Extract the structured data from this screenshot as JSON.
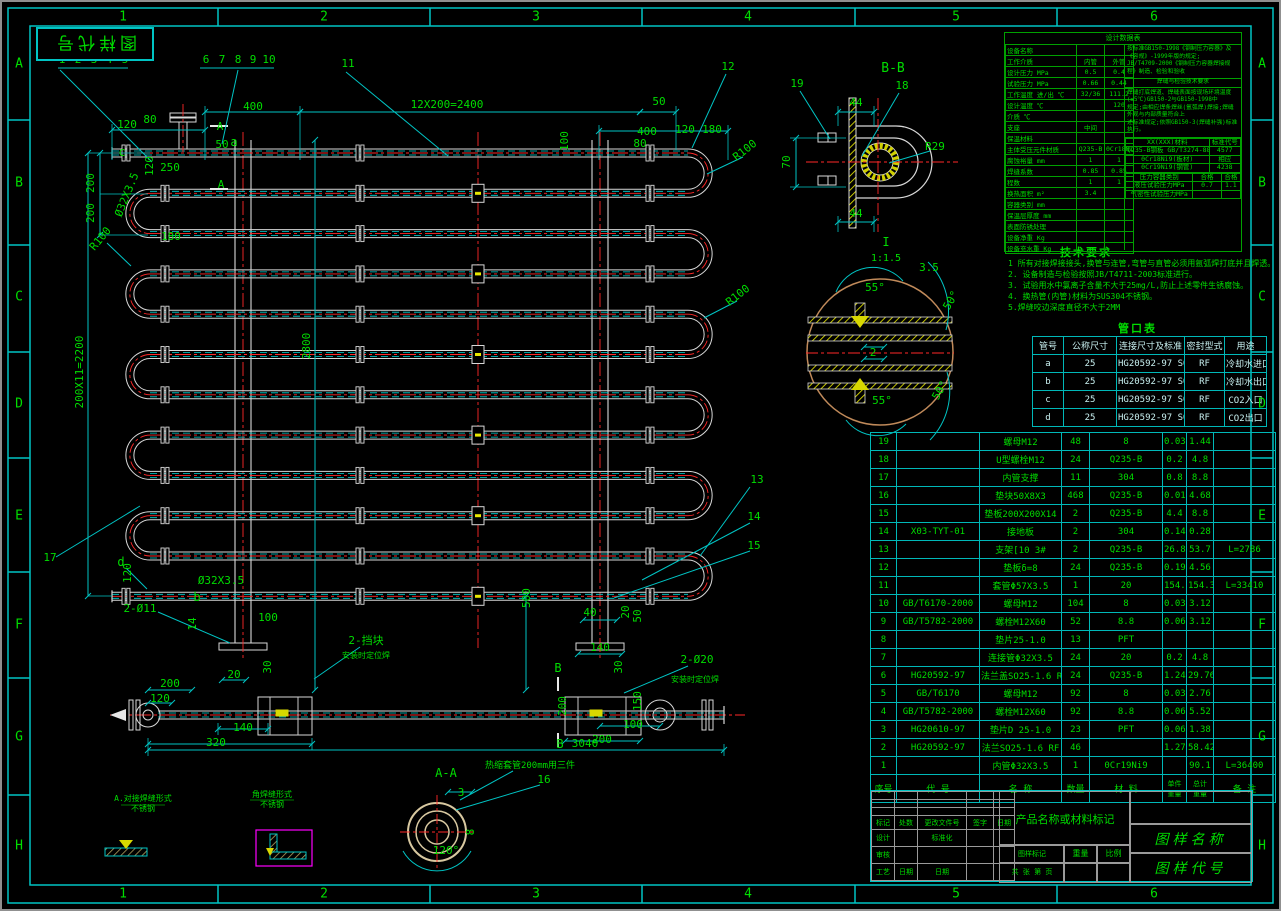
{
  "stamp": "图样代号",
  "frame": {
    "cols": [
      "1",
      "2",
      "3",
      "4",
      "5",
      "6"
    ],
    "rows": [
      "A",
      "B",
      "C",
      "D",
      "E",
      "F",
      "G",
      "H"
    ]
  },
  "tech_notes": {
    "title": "技术要求",
    "lines": [
      "1  所有对接焊接接头,换管与连管,弯管与直管必须用氩弧焊打底并且焊透。",
      "2. 设备制造与检验按照JB/T4711-2003标准进行。",
      "3. 试验用水中氯离子含量不大于25mg/L,防止上述零件生锈腐蚀。",
      "4. 换热管(内管)材料为SUS304不锈钢。",
      "5.焊缝咬边深度直径不大于2MM"
    ]
  },
  "nozzle_table": {
    "title": "管口表",
    "headers": [
      "管号",
      "公称尺寸",
      "连接尺寸及标准",
      "密封型式",
      "用途"
    ],
    "rows": [
      [
        "a",
        "25",
        "HG20592-97 SO25-1.6",
        "RF",
        "冷却水进口"
      ],
      [
        "b",
        "25",
        "HG20592-97 SO25-1.6",
        "RF",
        "冷却水出口"
      ],
      [
        "c",
        "25",
        "HG20592-97 SO25-1.6",
        "RF",
        "CO2入口"
      ],
      [
        "d",
        "25",
        "HG20592-97 SO25-1.6",
        "RF",
        "CO2出口"
      ]
    ]
  },
  "params_table": {
    "title": "设计数据表",
    "rows": [
      [
        "设备名称",
        "",
        ""
      ],
      [
        "工作介质",
        "内管",
        "外管"
      ],
      [
        "设计压力 MPa",
        "0.5",
        "0.4"
      ],
      [
        "试验压力 MPa",
        "0.66",
        "0.44"
      ],
      [
        "工作温度 进/出 ℃",
        "32/36",
        "111.2"
      ],
      [
        "设计温度 ℃",
        "",
        "120"
      ],
      [
        "介质 ℃",
        "",
        ""
      ],
      [
        "支座",
        "中间",
        ""
      ],
      [
        "保温材料",
        "",
        ""
      ],
      [
        "主体受压元件材质",
        "Q235-B",
        "0Cr18Ni9"
      ],
      [
        "腐蚀裕量 mm",
        "1",
        "1"
      ],
      [
        "焊缝系数",
        "0.85",
        "0.85"
      ],
      [
        "程数",
        "1",
        "1"
      ],
      [
        "换热面积 m²",
        "3.4",
        ""
      ],
      [
        "容器类别 mm",
        "",
        ""
      ],
      [
        "保温层厚度 mm",
        "",
        ""
      ],
      [
        "表面防锈处理",
        "",
        ""
      ],
      [
        "设备净重 Kg",
        "",
        ""
      ],
      [
        "设备充水重 Kg",
        "",
        ""
      ]
    ],
    "right": {
      "reg_lines": [
        "按标准GB150-1998《钢制压力容器》及《容规》-1999年版的规定;",
        "JB/T4709-2000《钢制压力容器焊接规程》制造、检验和验收"
      ],
      "weld_title": "焊缝与检验技术要求",
      "weld_lines": [
        "焊缝打底焊道、焊缝表面按现场环境温度(≥5℃)GB150-2与GB150-1998中",
        "规定;由相应焊条焊丝(氩弧焊)焊接;焊缝外观与内部质量符合上",
        "述标准规定;依照GB150-3(焊缝补强)标准执行。"
      ],
      "std_headers": [
        "XX(XXX)材料",
        "标准代号"
      ],
      "std_rows": [
        [
          "Q235-B钢板 GB/T3274-88",
          "4577"
        ],
        [
          "0Cr18Ni9(板材)",
          "相应"
        ],
        [
          "0Cr19Ni9(钢管)",
          "4238"
        ]
      ],
      "test_rows": [
        [
          "压力容器类别",
          "合格",
          "合格"
        ],
        [
          "液压试验压力MPa",
          "0.7",
          "1.1"
        ],
        [
          "气密性试验压力MPa",
          "",
          ""
        ]
      ]
    }
  },
  "bom": {
    "footer": [
      "序号",
      "代  号",
      "名  称",
      "数量",
      "材  料",
      "单件",
      "总计",
      "备  注"
    ],
    "weight_label": "重量",
    "rows": [
      [
        "19",
        "",
        "螺母M12",
        "48",
        "8",
        "0.03",
        "1.44",
        ""
      ],
      [
        "18",
        "",
        "U型螺栓M12",
        "24",
        "Q235-B",
        "0.2",
        "4.8",
        ""
      ],
      [
        "17",
        "",
        "内管支撑",
        "11",
        "304",
        "0.8",
        "8.8",
        ""
      ],
      [
        "16",
        "",
        "垫块50X8X3",
        "468",
        "Q235-B",
        "0.01",
        "4.68",
        ""
      ],
      [
        "15",
        "",
        "垫板200X200X14",
        "2",
        "Q235-B",
        "4.4",
        "8.8",
        ""
      ],
      [
        "14",
        "X03-TYT-01",
        "接地板",
        "2",
        "304",
        "0.14",
        "0.28",
        ""
      ],
      [
        "13",
        "",
        "支架[10 3#",
        "2",
        "Q235-B",
        "26.85",
        "53.7",
        "L=2786"
      ],
      [
        "12",
        "",
        "垫板δ=8",
        "24",
        "Q235-B",
        "0.19",
        "4.56",
        ""
      ],
      [
        "11",
        "",
        "套管Φ57X3.5",
        "1",
        "20",
        "154.3",
        "154.3",
        "L=33410"
      ],
      [
        "10",
        "GB/T6170-2000",
        "螺母M12",
        "104",
        "8",
        "0.03",
        "3.12",
        ""
      ],
      [
        "9",
        "GB/T5782-2000",
        "螺栓M12X60",
        "52",
        "8.8",
        "0.06",
        "3.12",
        ""
      ],
      [
        "8",
        "",
        "垫片25-1.0",
        "13",
        "PFT",
        "",
        "",
        ""
      ],
      [
        "7",
        "",
        "连接管Φ32X3.5",
        "24",
        "20",
        "0.2",
        "4.8",
        ""
      ],
      [
        "6",
        "HG20592-97",
        "法兰盖SO25-1.6 RF",
        "24",
        "Q235-B",
        "1.24",
        "29.76",
        ""
      ],
      [
        "5",
        "GB/T6170",
        "螺母M12",
        "92",
        "8",
        "0.03",
        "2.76",
        ""
      ],
      [
        "4",
        "GB/T5782-2000",
        "螺栓M12X60",
        "92",
        "8.8",
        "0.06",
        "5.52",
        ""
      ],
      [
        "3",
        "HG20610-97",
        "垫片D 25-1.0",
        "23",
        "PFT",
        "0.06",
        "1.38",
        ""
      ],
      [
        "2",
        "HG20592-97",
        "法兰SO25-1.6 RF",
        "46",
        "",
        "1.27",
        "58.42",
        ""
      ],
      [
        "1",
        "",
        "内管Φ32X3.5",
        "1",
        "0Cr19Ni9",
        "",
        "90.1",
        "L=36400"
      ]
    ]
  },
  "title_block": {
    "product_mark": "产品名称或材料标记",
    "name_label": "图样名称",
    "code_label": "图样代号",
    "left_header": [
      "标记",
      "处数",
      "更改文件号",
      "签字",
      "日期"
    ],
    "roles": [
      [
        "设计",
        "",
        "标准化",
        ""
      ],
      [
        "审核",
        "",
        "",
        ""
      ],
      [
        "工艺",
        "日期",
        "日期",
        ""
      ]
    ],
    "mark_label": "图样标记",
    "weight": "重量",
    "scale": "比例",
    "sheet": "共 张 第 页"
  },
  "annotations": [
    {
      "t": "1",
      "x": 62,
      "y": 63
    },
    {
      "t": "2",
      "x": 78,
      "y": 63
    },
    {
      "t": "3",
      "x": 94,
      "y": 63
    },
    {
      "t": "4",
      "x": 109,
      "y": 63
    },
    {
      "t": "5",
      "x": 125,
      "y": 63
    },
    {
      "t": "6",
      "x": 206,
      "y": 63
    },
    {
      "t": "7",
      "x": 222,
      "y": 63
    },
    {
      "t": "8",
      "x": 238,
      "y": 63
    },
    {
      "t": "9",
      "x": 253,
      "y": 63
    },
    {
      "t": "10",
      "x": 269,
      "y": 63
    },
    {
      "t": "11",
      "x": 348,
      "y": 67
    },
    {
      "t": "12",
      "x": 728,
      "y": 70
    },
    {
      "t": "a",
      "x": 234,
      "y": 146,
      "s": 12
    },
    {
      "t": "400",
      "x": 253,
      "y": 110
    },
    {
      "t": "12X200=2400",
      "x": 447,
      "y": 108
    },
    {
      "t": "50",
      "x": 659,
      "y": 105
    },
    {
      "t": "120",
      "x": 127,
      "y": 128
    },
    {
      "t": "80",
      "x": 150,
      "y": 123
    },
    {
      "t": "A",
      "x": 220,
      "y": 130
    },
    {
      "t": "50",
      "x": 222,
      "y": 148
    },
    {
      "t": "120",
      "x": 153,
      "y": 166,
      "r": -90
    },
    {
      "t": "c",
      "x": 122,
      "y": 156,
      "s": 12
    },
    {
      "t": "250",
      "x": 170,
      "y": 171
    },
    {
      "t": "A",
      "x": 221,
      "y": 188
    },
    {
      "t": "100",
      "x": 568,
      "y": 141,
      "r": -90
    },
    {
      "t": "400",
      "x": 647,
      "y": 135
    },
    {
      "t": "80",
      "x": 640,
      "y": 147
    },
    {
      "t": "120",
      "x": 685,
      "y": 133
    },
    {
      "t": "180",
      "x": 712,
      "y": 133
    },
    {
      "t": "R100",
      "x": 747,
      "y": 153,
      "r": -38
    },
    {
      "t": "Ø32X3.5",
      "x": 130,
      "y": 196,
      "r": -68
    },
    {
      "t": "200",
      "x": 94,
      "y": 183,
      "r": -90
    },
    {
      "t": "200",
      "x": 94,
      "y": 213,
      "r": -90
    },
    {
      "t": "R100",
      "x": 103,
      "y": 241,
      "r": -50
    },
    {
      "t": "180",
      "x": 171,
      "y": 240
    },
    {
      "t": "200X11=2200",
      "x": 83,
      "y": 372,
      "r": -90
    },
    {
      "t": "2800",
      "x": 310,
      "y": 346,
      "r": -90
    },
    {
      "t": "R100",
      "x": 740,
      "y": 298,
      "r": -38
    },
    {
      "t": "13",
      "x": 757,
      "y": 483
    },
    {
      "t": "14",
      "x": 754,
      "y": 520
    },
    {
      "t": "15",
      "x": 754,
      "y": 549
    },
    {
      "t": "17",
      "x": 50,
      "y": 561
    },
    {
      "t": "d",
      "x": 121,
      "y": 566,
      "s": 12
    },
    {
      "t": "120",
      "x": 131,
      "y": 573,
      "r": -90
    },
    {
      "t": "Ø32X3.5",
      "x": 221,
      "y": 584
    },
    {
      "t": "b",
      "x": 197,
      "y": 601,
      "s": 12
    },
    {
      "t": "2-Ø11",
      "x": 140,
      "y": 612
    },
    {
      "t": "14",
      "x": 196,
      "y": 624,
      "r": -90
    },
    {
      "t": "100",
      "x": 268,
      "y": 621
    },
    {
      "t": "2-挡块",
      "x": 366,
      "y": 644
    },
    {
      "t": "安装时定位焊",
      "x": 366,
      "y": 658,
      "s": 8
    },
    {
      "t": "200",
      "x": 170,
      "y": 687
    },
    {
      "t": "120",
      "x": 160,
      "y": 702
    },
    {
      "t": "20",
      "x": 234,
      "y": 678
    },
    {
      "t": "30",
      "x": 271,
      "y": 667,
      "r": -90
    },
    {
      "t": "140",
      "x": 243,
      "y": 731
    },
    {
      "t": "320",
      "x": 216,
      "y": 746
    },
    {
      "t": "3040",
      "x": 585,
      "y": 747
    },
    {
      "t": "500",
      "x": 530,
      "y": 598,
      "r": -90
    },
    {
      "t": "40",
      "x": 590,
      "y": 616
    },
    {
      "t": "20",
      "x": 629,
      "y": 612,
      "r": -90
    },
    {
      "t": "50",
      "x": 641,
      "y": 616,
      "r": -90
    },
    {
      "t": "140",
      "x": 600,
      "y": 651
    },
    {
      "t": "B",
      "x": 558,
      "y": 672,
      "s": 12
    },
    {
      "t": "30",
      "x": 622,
      "y": 667,
      "r": -90
    },
    {
      "t": "2-Ø20",
      "x": 697,
      "y": 663
    },
    {
      "t": "安装时定位焊",
      "x": 695,
      "y": 682,
      "s": 8
    },
    {
      "t": "200",
      "x": 566,
      "y": 706,
      "r": -90
    },
    {
      "t": "150",
      "x": 641,
      "y": 701,
      "r": -90
    },
    {
      "t": "100",
      "x": 633,
      "y": 728
    },
    {
      "t": "200",
      "x": 602,
      "y": 743
    },
    {
      "t": "B",
      "x": 560,
      "y": 748,
      "s": 12
    },
    {
      "t": "A-A",
      "x": 446,
      "y": 777,
      "s": 12
    },
    {
      "t": "热缩套管200mm用三件",
      "x": 530,
      "y": 768,
      "s": 9
    },
    {
      "t": "16",
      "x": 544,
      "y": 783
    },
    {
      "t": "3",
      "x": 461,
      "y": 796
    },
    {
      "t": "8",
      "x": 474,
      "y": 832,
      "r": -90
    },
    {
      "t": "120°",
      "x": 446,
      "y": 854
    },
    {
      "t": "A.对接焊缝形式",
      "x": 143,
      "y": 801,
      "s": 8
    },
    {
      "t": "不锈钢",
      "x": 143,
      "y": 811,
      "s": 8
    },
    {
      "t": "角焊缝形式",
      "x": 272,
      "y": 797,
      "s": 8
    },
    {
      "t": "不锈钢",
      "x": 272,
      "y": 807,
      "s": 8
    },
    {
      "t": "B-B",
      "x": 893,
      "y": 72,
      "s": 13
    },
    {
      "t": "19",
      "x": 797,
      "y": 87
    },
    {
      "t": "18",
      "x": 902,
      "y": 89
    },
    {
      "t": "44",
      "x": 856,
      "y": 106
    },
    {
      "t": "70",
      "x": 790,
      "y": 162,
      "r": -90
    },
    {
      "t": "44",
      "x": 856,
      "y": 217
    },
    {
      "t": "R29",
      "x": 935,
      "y": 150
    },
    {
      "t": "I",
      "x": 886,
      "y": 246,
      "s": 12
    },
    {
      "t": "1:1.5",
      "x": 886,
      "y": 261,
      "s": 10
    },
    {
      "t": "3.5",
      "x": 929,
      "y": 271
    },
    {
      "t": "55°",
      "x": 875,
      "y": 291
    },
    {
      "t": "50°",
      "x": 954,
      "y": 302,
      "r": -60
    },
    {
      "t": "2",
      "x": 873,
      "y": 356
    },
    {
      "t": "55°",
      "x": 882,
      "y": 404
    },
    {
      "t": "50°",
      "x": 943,
      "y": 392,
      "r": -60
    }
  ]
}
